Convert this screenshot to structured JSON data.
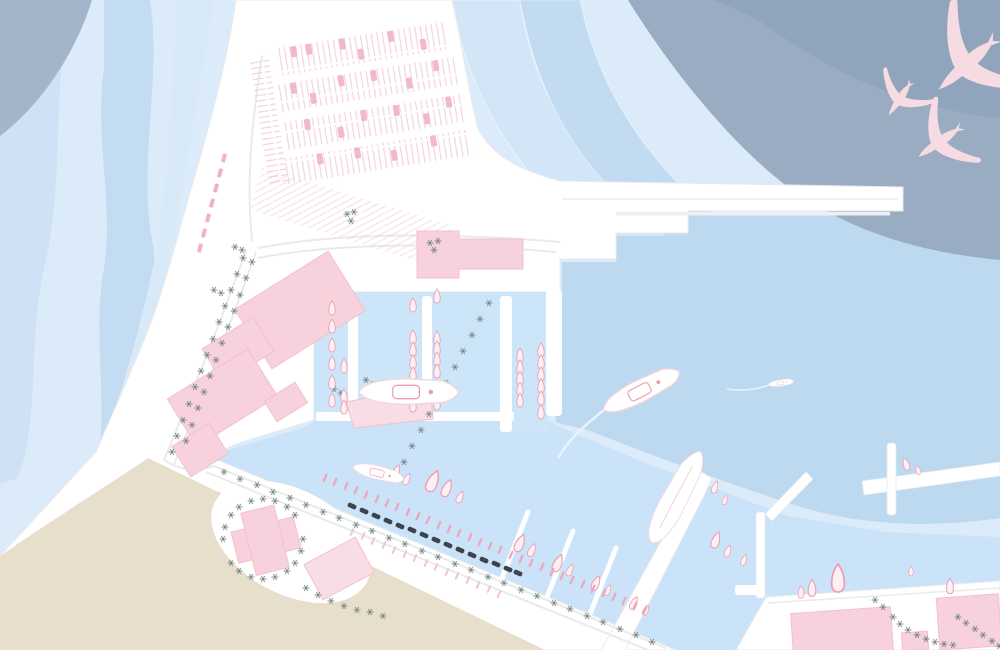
{
  "scene": {
    "kind": "illustrated-harbor-marina-map",
    "width": 1000,
    "height": 650
  },
  "palette": {
    "water_base": "#dcebf9",
    "snake1": "#cfe2f5",
    "snake2": "#c3dcf2",
    "snake3": "#d8e9f8",
    "sweep1": "#d3e6f7",
    "sweep2": "#c2dbf1",
    "light_patch": "#bdd9ef",
    "deep": "#99acc1",
    "deep_inner": "#90a4bb",
    "slate_corner": "#a3b5c8",
    "near_shore": "#cbe3f8",
    "marina": "#cde5f9",
    "land": "#ffffff",
    "land_edge": "#e7eaee",
    "beach": "#e7dfcc",
    "road": "#e9eaec",
    "pier_shadow": "#edf0f4",
    "building": "#f7d2dc",
    "building_soft": "#f9dde5",
    "building_edge": "#f2c0ce",
    "boat_fill": "#fdf0f4",
    "boat_stroke": "#ec9fb2",
    "yacht_trim": "#f3d7de",
    "wake": "#e9f3fc",
    "hatch_pink": "#f0c3d1",
    "car_pink": "#f2b9c8",
    "queue_pink": "#efb3c2",
    "dinghy_pink": "#eba9bb",
    "rack_pink": "#f3c3d0",
    "tree": "#76857e",
    "dark_mark": "#3e444d",
    "bird": "#f7dbe3",
    "white": "#ffffff"
  },
  "features": {
    "trees": {
      "symbol": "sym-tree",
      "layer": "trees-layer",
      "points": [
        [
          243,
          258
        ],
        [
          237,
          274
        ],
        [
          231,
          290
        ],
        [
          225,
          306
        ],
        [
          219,
          322
        ],
        [
          213,
          339
        ],
        [
          207,
          355
        ],
        [
          201,
          371
        ],
        [
          195,
          387
        ],
        [
          189,
          404
        ],
        [
          183,
          420
        ],
        [
          177,
          436
        ],
        [
          172,
          452
        ],
        [
          252,
          262
        ],
        [
          246,
          278
        ],
        [
          240,
          295
        ],
        [
          234,
          311
        ],
        [
          228,
          327
        ],
        [
          222,
          343
        ],
        [
          216,
          360
        ],
        [
          210,
          376
        ],
        [
          204,
          392
        ],
        [
          198,
          408
        ],
        [
          192,
          425
        ],
        [
          186,
          441
        ],
        [
          489,
          303
        ],
        [
          480,
          319
        ],
        [
          472,
          335
        ],
        [
          463,
          351
        ],
        [
          455,
          367
        ],
        [
          446,
          383
        ],
        [
          438,
          399
        ],
        [
          429,
          414
        ],
        [
          421,
          430
        ],
        [
          412,
          446
        ],
        [
          404,
          462
        ],
        [
          224,
          472
        ],
        [
          240,
          479
        ],
        [
          257,
          485
        ],
        [
          273,
          492
        ],
        [
          290,
          498
        ],
        [
          306,
          505
        ],
        [
          323,
          512
        ],
        [
          339,
          518
        ],
        [
          356,
          525
        ],
        [
          372,
          531
        ],
        [
          389,
          538
        ],
        [
          405,
          544
        ],
        [
          422,
          551
        ],
        [
          438,
          557
        ],
        [
          455,
          564
        ],
        [
          471,
          570
        ],
        [
          488,
          577
        ],
        [
          504,
          583
        ],
        [
          521,
          590
        ],
        [
          537,
          596
        ],
        [
          554,
          603
        ],
        [
          570,
          609
        ],
        [
          587,
          616
        ],
        [
          603,
          622
        ],
        [
          620,
          629
        ],
        [
          636,
          635
        ],
        [
          652,
          642
        ],
        [
          306,
          588
        ],
        [
          318,
          595
        ],
        [
          331,
          601
        ],
        [
          344,
          606
        ],
        [
          357,
          610
        ],
        [
          370,
          612
        ],
        [
          383,
          616
        ],
        [
          223,
          539
        ],
        [
          225,
          527
        ],
        [
          231,
          515
        ],
        [
          239,
          507
        ],
        [
          251,
          501
        ],
        [
          263,
          499
        ],
        [
          275,
          501
        ],
        [
          287,
          507
        ],
        [
          295,
          515
        ],
        [
          303,
          539
        ],
        [
          301,
          551
        ],
        [
          295,
          563
        ],
        [
          287,
          571
        ],
        [
          275,
          577
        ],
        [
          263,
          579
        ],
        [
          251,
          577
        ],
        [
          239,
          571
        ],
        [
          231,
          563
        ],
        [
          875,
          600
        ],
        [
          883,
          607
        ],
        [
          893,
          617
        ],
        [
          900,
          624
        ],
        [
          908,
          630
        ],
        [
          917,
          635
        ],
        [
          926,
          639
        ],
        [
          935,
          642
        ],
        [
          944,
          644
        ],
        [
          953,
          645
        ],
        [
          958,
          617
        ],
        [
          966,
          623
        ],
        [
          975,
          629
        ],
        [
          983,
          635
        ],
        [
          992,
          641
        ],
        [
          999,
          646
        ],
        [
          347,
          214
        ],
        [
          354,
          212
        ],
        [
          351,
          221
        ],
        [
          430,
          243
        ],
        [
          438,
          241
        ],
        [
          434,
          250
        ],
        [
          214,
          290
        ],
        [
          221,
          293
        ],
        [
          235,
          247
        ],
        [
          242,
          250
        ],
        [
          366,
          380
        ],
        [
          373,
          384
        ],
        [
          334,
          389
        ],
        [
          341,
          393
        ]
      ]
    },
    "parking_cars": {
      "symbol": "sym-car",
      "layer": "parking-cars",
      "points": [
        [
          303,
          42
        ],
        [
          318,
          42
        ],
        [
          352,
          42
        ],
        [
          369,
          55
        ],
        [
          401,
          42
        ],
        [
          432,
          55
        ],
        [
          297,
          78
        ],
        [
          315,
          91
        ],
        [
          345,
          78
        ],
        [
          378,
          78
        ],
        [
          412,
          91
        ],
        [
          441,
          78
        ],
        [
          305,
          116
        ],
        [
          337,
          129
        ],
        [
          362,
          116
        ],
        [
          395,
          116
        ],
        [
          424,
          129
        ],
        [
          448,
          116
        ],
        [
          312,
          152
        ],
        [
          350,
          152
        ],
        [
          386,
          160
        ],
        [
          427,
          152
        ]
      ]
    },
    "queue_ticks": {
      "symbol": "sym-qtick",
      "layer": "queue-ticks",
      "rot": 15,
      "points": [
        [
          224,
          158
        ],
        [
          220,
          173
        ],
        [
          216,
          188
        ],
        [
          212,
          203
        ],
        [
          208,
          218
        ],
        [
          204,
          233
        ],
        [
          200,
          248
        ]
      ]
    },
    "marina_boats": {
      "symbol": "sym-boat",
      "layer": "marina-boats",
      "points": [
        [
          332,
          308
        ],
        [
          332,
          326
        ],
        [
          332,
          345
        ],
        [
          332,
          363
        ],
        [
          332,
          382
        ],
        [
          332,
          400
        ],
        [
          344,
          366
        ],
        [
          344,
          396
        ],
        [
          344,
          407
        ],
        [
          413,
          305
        ],
        [
          413,
          337
        ],
        [
          413,
          349
        ],
        [
          413,
          362
        ],
        [
          413,
          374
        ],
        [
          413,
          393
        ],
        [
          413,
          405
        ],
        [
          437,
          296
        ],
        [
          437,
          338
        ],
        [
          437,
          348
        ],
        [
          437,
          359
        ],
        [
          437,
          371
        ],
        [
          437,
          388
        ],
        [
          437,
          403
        ],
        [
          520,
          355
        ],
        [
          520,
          367
        ],
        [
          520,
          378
        ],
        [
          520,
          389
        ],
        [
          520,
          400
        ],
        [
          541,
          350
        ],
        [
          541,
          362
        ],
        [
          541,
          374
        ],
        [
          541,
          386
        ],
        [
          541,
          398
        ],
        [
          541,
          412
        ]
      ]
    },
    "angled_boats": {
      "symbol": "sym-boat",
      "layer": "angled-boats",
      "points": [
        [
          396,
          472,
          1.1,
          24
        ],
        [
          407,
          479,
          0.9,
          24
        ],
        [
          433,
          481,
          1.6,
          24
        ],
        [
          447,
          488,
          1.3,
          24
        ],
        [
          460,
          497,
          0.9,
          24
        ],
        [
          520,
          543,
          1.3,
          24
        ],
        [
          532,
          550,
          1.0,
          24
        ],
        [
          558,
          563,
          1.3,
          24
        ],
        [
          570,
          570,
          0.9,
          24
        ],
        [
          596,
          583,
          1.1,
          24
        ],
        [
          608,
          590,
          0.8,
          24
        ],
        [
          634,
          603,
          1.0,
          24
        ],
        [
          646,
          610,
          0.8,
          24
        ],
        [
          716,
          540,
          1.2,
          20
        ],
        [
          728,
          551,
          0.9,
          20
        ],
        [
          715,
          487,
          0.9,
          20
        ],
        [
          725,
          500,
          0.7,
          20
        ],
        [
          744,
          560,
          0.8,
          20
        ],
        [
          906,
          464,
          0.9,
          -20
        ],
        [
          918,
          470,
          0.7,
          -20
        ]
      ]
    },
    "quay_boats": {
      "symbol": "sym-boat",
      "layer": "quay-boats",
      "points": [
        [
          801,
          592,
          0.9,
          0
        ],
        [
          812,
          588,
          1.2,
          0
        ],
        [
          838,
          578,
          2.0,
          0
        ],
        [
          950,
          586,
          1.1,
          0
        ],
        [
          911,
          571,
          0.7,
          0
        ]
      ]
    },
    "dinghies": {
      "symbol": "sym-dinghy",
      "layer": "dinghy-row",
      "rot": 24,
      "points": [
        [
          325,
          478
        ],
        [
          335,
          482
        ],
        [
          346,
          486
        ],
        [
          356,
          490
        ],
        [
          366,
          495
        ],
        [
          377,
          499
        ],
        [
          387,
          503
        ],
        [
          397,
          507
        ],
        [
          408,
          512
        ],
        [
          418,
          516
        ],
        [
          428,
          520
        ],
        [
          439,
          525
        ],
        [
          449,
          529
        ],
        [
          459,
          533
        ],
        [
          470,
          537
        ],
        [
          480,
          542
        ],
        [
          490,
          546
        ],
        [
          500,
          550
        ],
        [
          511,
          555
        ],
        [
          521,
          559
        ],
        [
          531,
          563
        ],
        [
          542,
          567
        ],
        [
          552,
          572
        ],
        [
          562,
          576
        ],
        [
          572,
          580
        ],
        [
          583,
          584
        ],
        [
          593,
          589
        ],
        [
          604,
          593
        ],
        [
          614,
          597
        ],
        [
          624,
          601
        ],
        [
          635,
          606
        ],
        [
          645,
          610
        ]
      ]
    },
    "rack_ticks": {
      "symbol": "sym-rack",
      "layer": "rack-row",
      "rot": 24,
      "points": [
        [
          352,
          532
        ],
        [
          363,
          536
        ],
        [
          373,
          541
        ],
        [
          384,
          545
        ],
        [
          394,
          550
        ],
        [
          405,
          554
        ],
        [
          415,
          558
        ],
        [
          426,
          563
        ],
        [
          436,
          567
        ],
        [
          447,
          572
        ],
        [
          457,
          576
        ],
        [
          468,
          580
        ],
        [
          478,
          585
        ],
        [
          489,
          589
        ],
        [
          499,
          594
        ]
      ]
    },
    "dark_marks": {
      "symbol": "sym-darkmark",
      "layer": "dark-marks",
      "rot": 24,
      "points": [
        [
          352,
          506
        ],
        [
          364,
          511
        ],
        [
          376,
          516
        ],
        [
          388,
          521
        ],
        [
          400,
          526
        ],
        [
          412,
          530
        ],
        [
          424,
          535
        ],
        [
          436,
          540
        ],
        [
          448,
          545
        ],
        [
          460,
          550
        ],
        [
          472,
          555
        ],
        [
          484,
          560
        ],
        [
          496,
          564
        ],
        [
          508,
          569
        ],
        [
          518,
          573
        ]
      ]
    },
    "birds": {
      "symbol": "sym-bird",
      "layer": "birds-layer",
      "points": [
        [
          965,
          66,
          2.2,
          228
        ],
        [
          899,
          100,
          1.15,
          214
        ],
        [
          938,
          143,
          1.5,
          235
        ]
      ]
    }
  }
}
